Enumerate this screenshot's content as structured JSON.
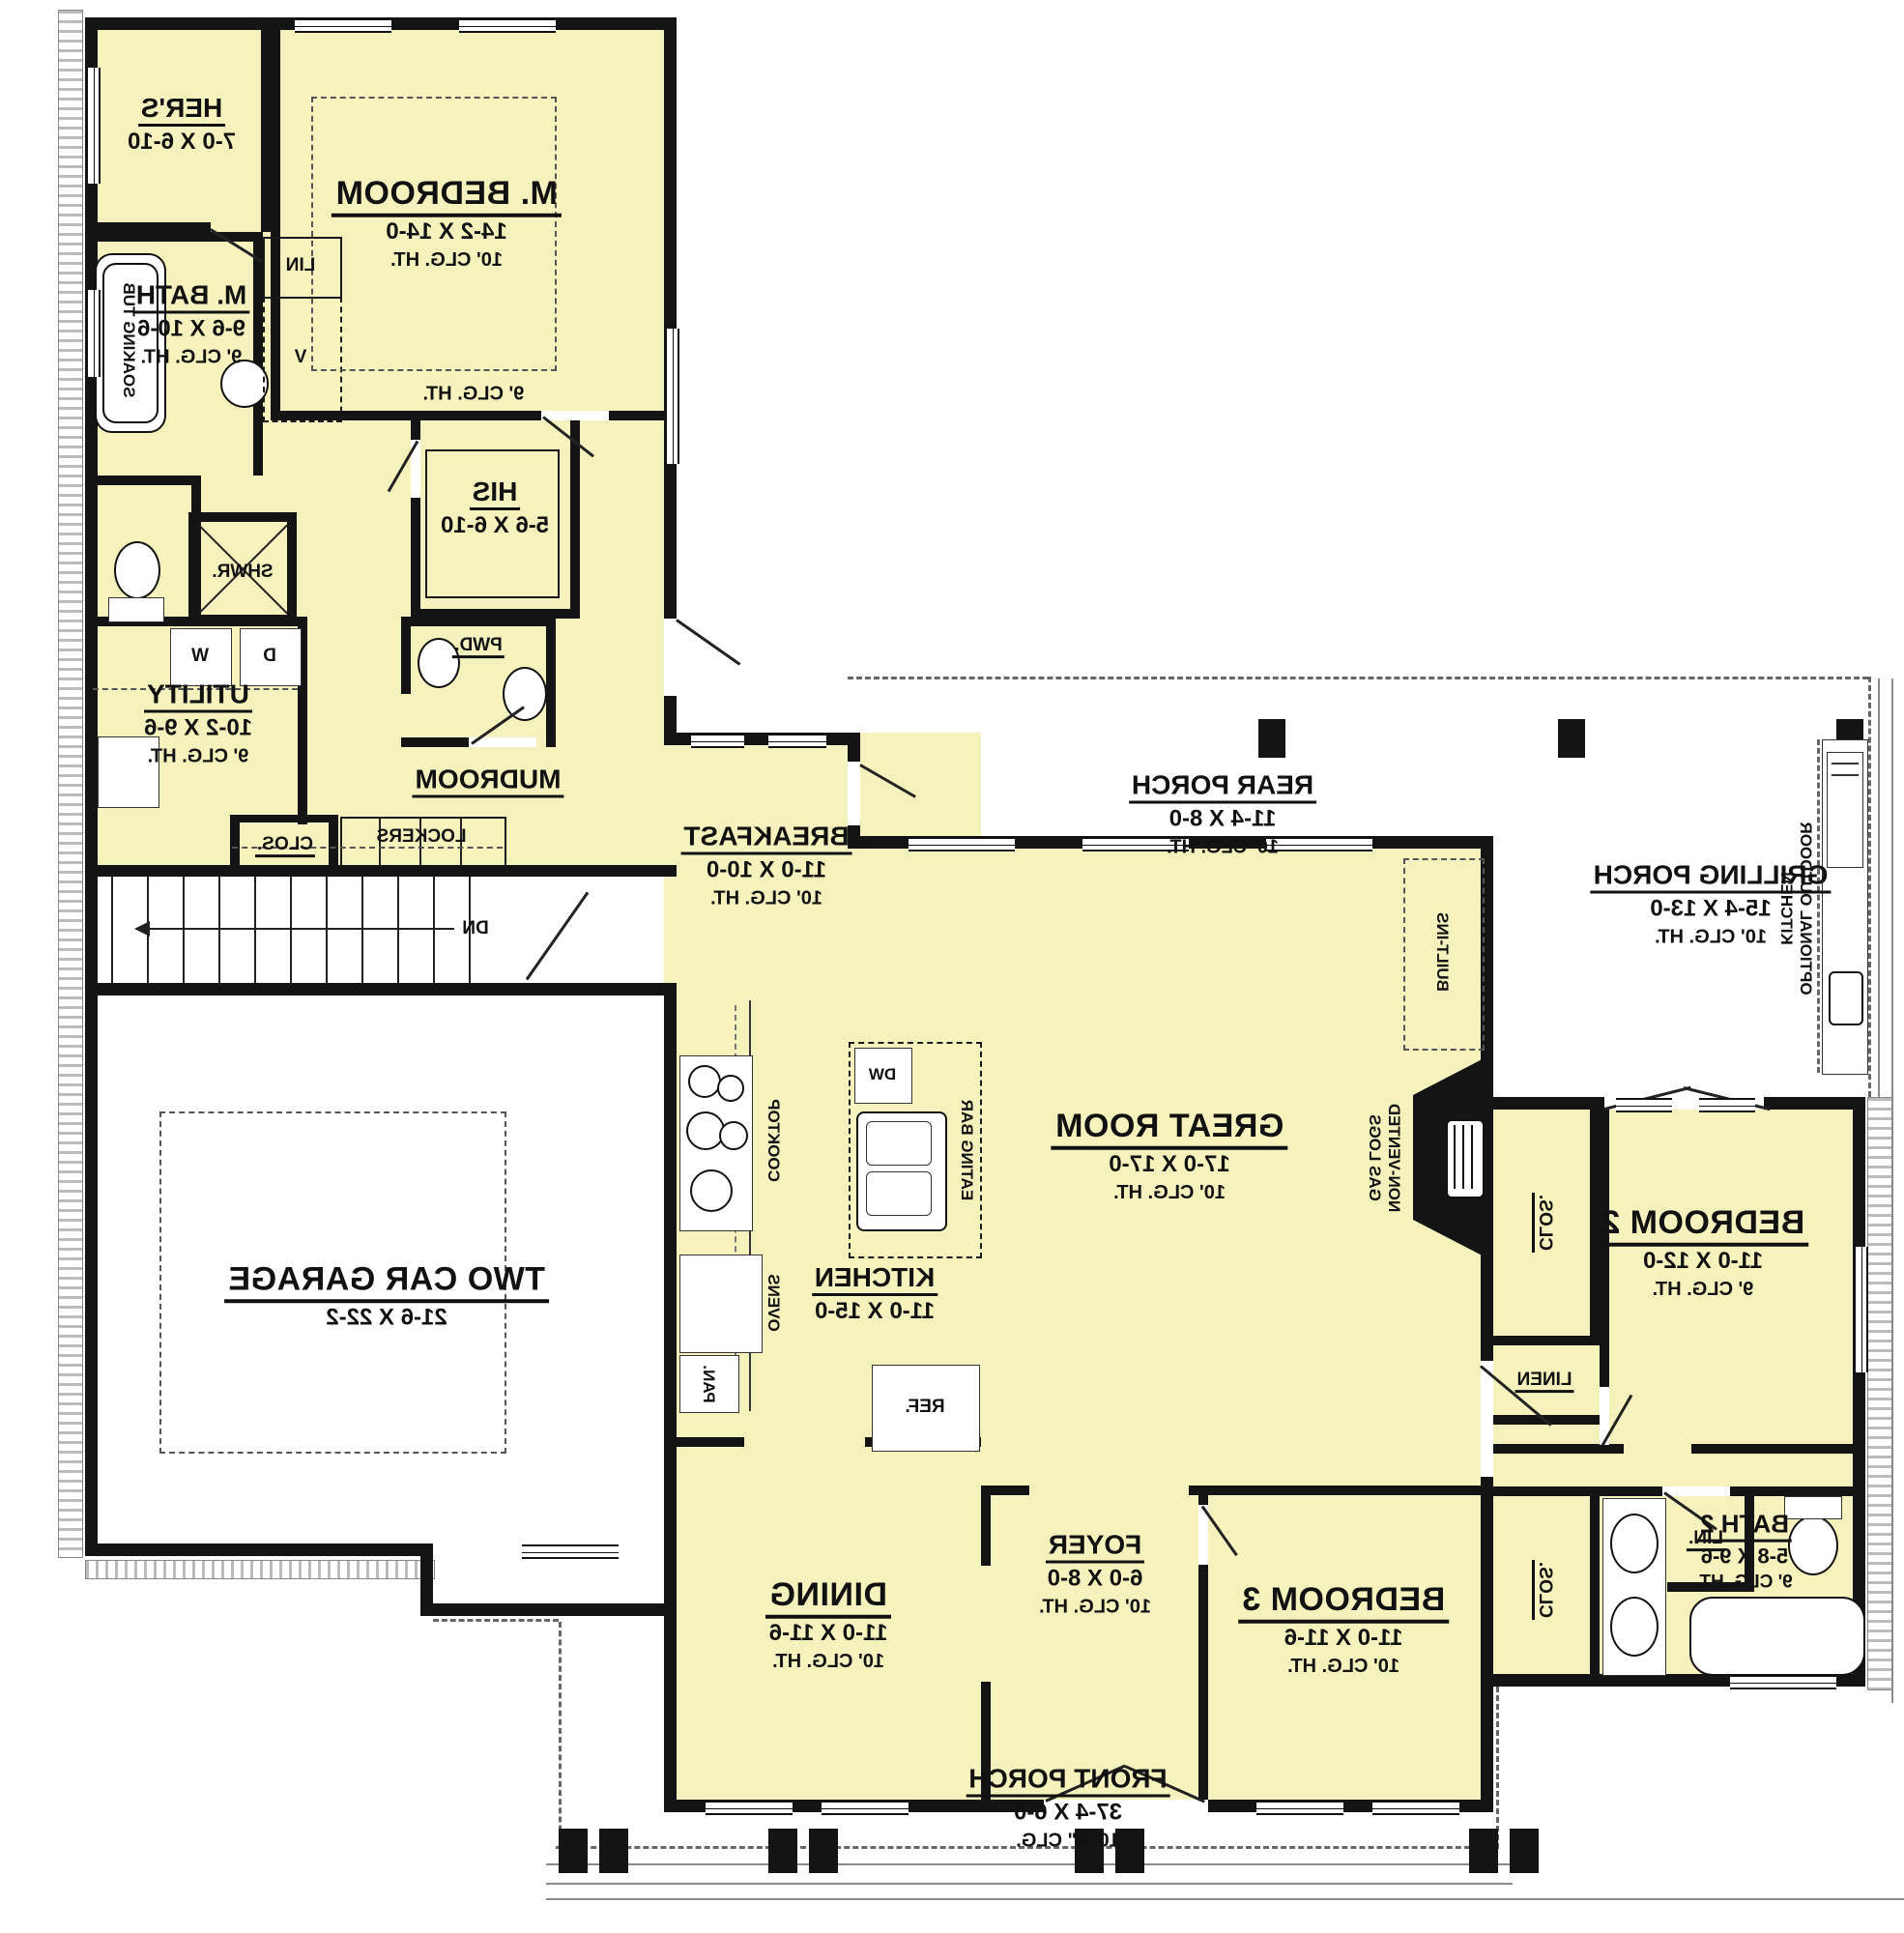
{
  "rooms": {
    "her": {
      "name": "HER'S",
      "dims": "7-0 X 6-10"
    },
    "mbed": {
      "name": "M. BEDROOM",
      "dims": "14-2 X 14-0",
      "ceiling": "10' CLG. HT."
    },
    "mbath": {
      "name": "M. BATH",
      "dims": "9-6 X 10-6",
      "ceiling": "9' CLG. HT."
    },
    "his": {
      "name": "HIS",
      "dims": "5-6 X 6-10"
    },
    "utility": {
      "name": "UTILITY",
      "dims": "10-2 X 9-6",
      "ceiling": "9' CLG. HT."
    },
    "mudroom": {
      "name": "MUDROOM"
    },
    "breakfast": {
      "name": "BREAKFAST",
      "dims": "11-0 X 10-0",
      "ceiling": "10' CLG. HT."
    },
    "rearPorch": {
      "name": "REAR PORCH",
      "dims": "11-4 X 8-0",
      "ceiling": "10' CLG. HT."
    },
    "grillPorch": {
      "name": "GRILLING PORCH",
      "dims": "15-4 X 13-0",
      "ceiling": "10' CLG. HT."
    },
    "greatRoom": {
      "name": "GREAT ROOM",
      "dims": "17-0 X 17-0",
      "ceiling": "10' CLG. HT."
    },
    "kitchen": {
      "name": "KITCHEN",
      "dims": "11-0 X 15-0"
    },
    "garage": {
      "name": "TWO CAR GARAGE",
      "dims": "21-6 X 22-2"
    },
    "bed2": {
      "name": "BEDROOM 2",
      "dims": "11-0 X 12-0",
      "ceiling": "9' CLG. HT."
    },
    "bed3": {
      "name": "BEDROOM 3",
      "dims": "11-0 X 11-6",
      "ceiling": "10' CLG. HT."
    },
    "bath2": {
      "name": "BATH 2",
      "dims": "5-8 X 9-6",
      "ceiling": "9' CLG. HT."
    },
    "dining": {
      "name": "DINING",
      "dims": "11-0 X 11-6",
      "ceiling": "10' CLG. HT."
    },
    "foyer": {
      "name": "FOYER",
      "dims": "6-0 X 8-0",
      "ceiling": "10' CLG. HT."
    },
    "frontPorch": {
      "name": "FRONT PORCH",
      "dims": "37-4 X 6-0",
      "ceiling": "10'-0\" CLG."
    }
  },
  "labels": {
    "soakingTub": "SOAKING TUB",
    "lin": "LIN",
    "vanity": "V",
    "shwr": "SHWR.",
    "pwd": "PWD.",
    "washer": "W",
    "dryer": "D",
    "closMud": "CLOS.",
    "lockers": "LOCKERS",
    "dn": "DN",
    "hallCeiling": "9' CLG. HT.",
    "cooktop": "COOKTOP",
    "ovens": "OVENS",
    "pan": "PAN.",
    "eatingBar": "EATING BAR",
    "dw": "DW",
    "ref": "REF.",
    "builtIns": "BUILT-INS",
    "gasLogs1": "NON-VENTED",
    "gasLogs2": "GAS LOGS",
    "linen": "LINEN",
    "closBed2": "CLOS.",
    "closBed3": "CLOS.",
    "linBath2": "LIN.",
    "outdoorKit1": "OPTIONAL OUTDOOR",
    "outdoorKit2": "KITCHEN"
  },
  "colors": {
    "roomFill": "#f6f2bd",
    "wall": "#141414",
    "porch": "#ffffff"
  }
}
